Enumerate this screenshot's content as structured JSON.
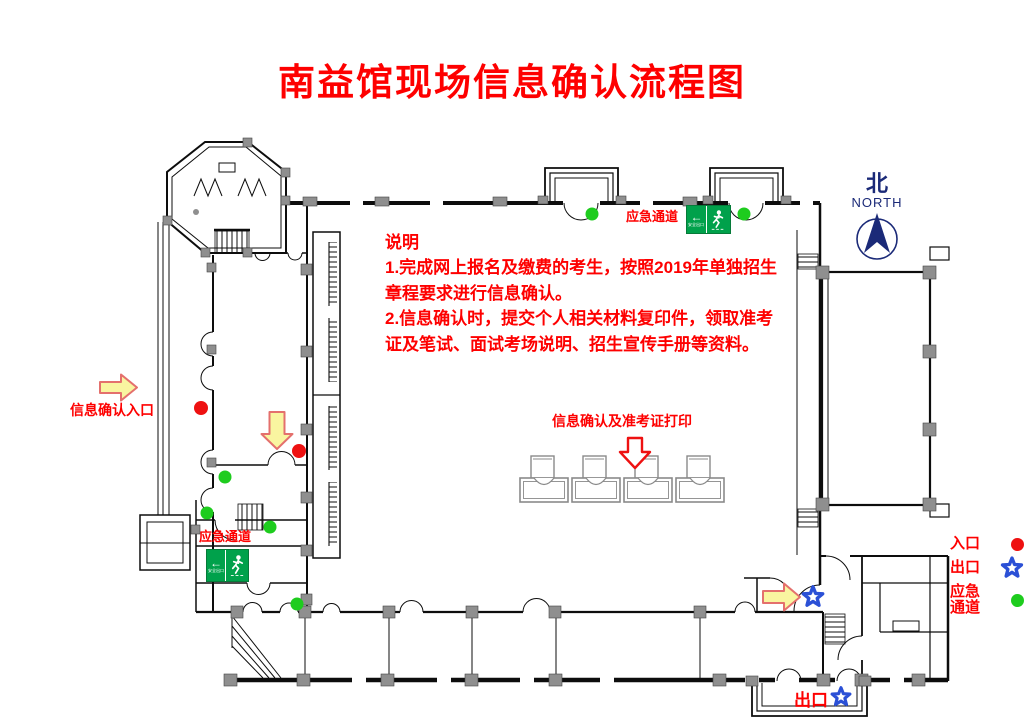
{
  "title": "南益馆现场信息确认流程图",
  "notes": {
    "heading": "说明",
    "body": "1.完成网上报名及缴费的考生，按照2019年单独招生\n章程要求进行信息确认。\n2.信息确认时，提交个人相关材料复印件，领取准考\n证及笔试、面试考场说明、招生宣传手册等资料。"
  },
  "plan_labels": {
    "emergency_top": "应急通道",
    "emergency_left": "应急通道",
    "entrance": "信息确认入口",
    "confirm_area": "信息确认及准考证打印",
    "exit_bottom": "出口"
  },
  "exit_sign_text": "安全出口",
  "compass": {
    "cn": "北",
    "en": "NORTH"
  },
  "legend": {
    "entrance_label": "入口",
    "exit_label": "出口",
    "emergency_label": "应急\n通道"
  },
  "icons": {
    "entrance_marker": "red-circle",
    "exit_marker": "blue-star",
    "emergency_marker": "green-circle",
    "flow_arrow": "yellow-block-arrow",
    "confirm_arrow": "red-outline-down-arrow",
    "exit_sign": "green-exit-running-man-sign",
    "compass": "north-compass-arrow"
  },
  "colors": {
    "label_red": "#fe0000",
    "marker_red": "#ee1111",
    "marker_green": "#1ecc1e",
    "star_blue": "#2b50d6",
    "arrow_fill": "#f9f5a0",
    "arrow_stroke": "#e4706d",
    "exit_sign_green": "#00a14b",
    "compass_navy": "#1b2a78",
    "wall_black": "#0d0d0d",
    "column_gray": "#8f8f8f"
  }
}
